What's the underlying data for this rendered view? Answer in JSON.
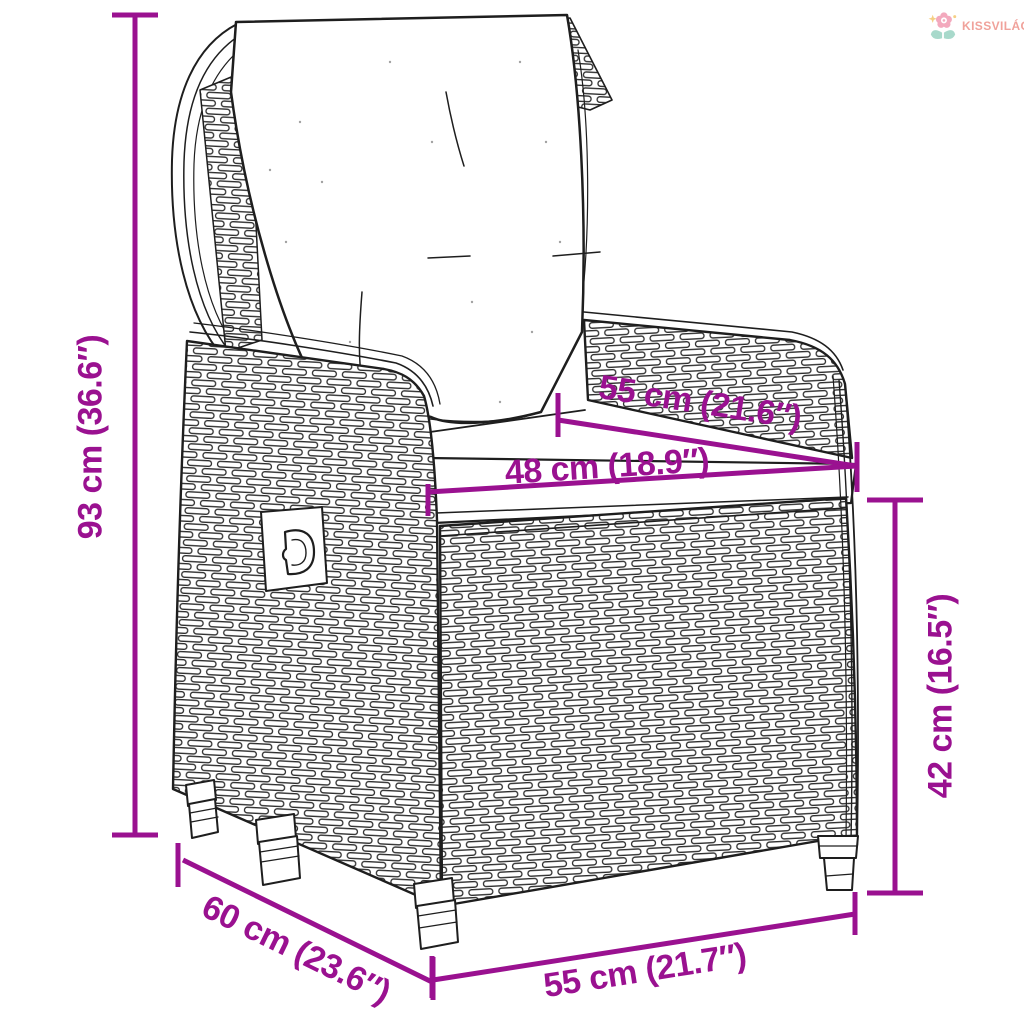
{
  "page": {
    "background": "#ffffff"
  },
  "brand": {
    "name": "KISSVILÁG",
    "icon": "flower-sprout-icon",
    "text_color": "#f0a29b",
    "flower_pink": "#f3a9bd",
    "leaf_teal": "#a8d9cb",
    "star_yellow": "#f5cf84"
  },
  "diagram": {
    "subject": "reclining poly rattan garden armchair with back and seat cushion, line drawing with measurements",
    "accent_color": "#9a1190",
    "art_color": "#1e1e1e",
    "dimensions": [
      {
        "id": "total-height",
        "label": "93 cm (36.6″)"
      },
      {
        "id": "back-depth",
        "label": "55 cm (21.6″)"
      },
      {
        "id": "seat-width",
        "label": "48 cm (18.9″)"
      },
      {
        "id": "seat-height",
        "label": "42 cm (16.5″)"
      },
      {
        "id": "side-depth",
        "label": "60 cm (23.6″)"
      },
      {
        "id": "front-width",
        "label": "55 cm (21.7″)"
      }
    ]
  }
}
